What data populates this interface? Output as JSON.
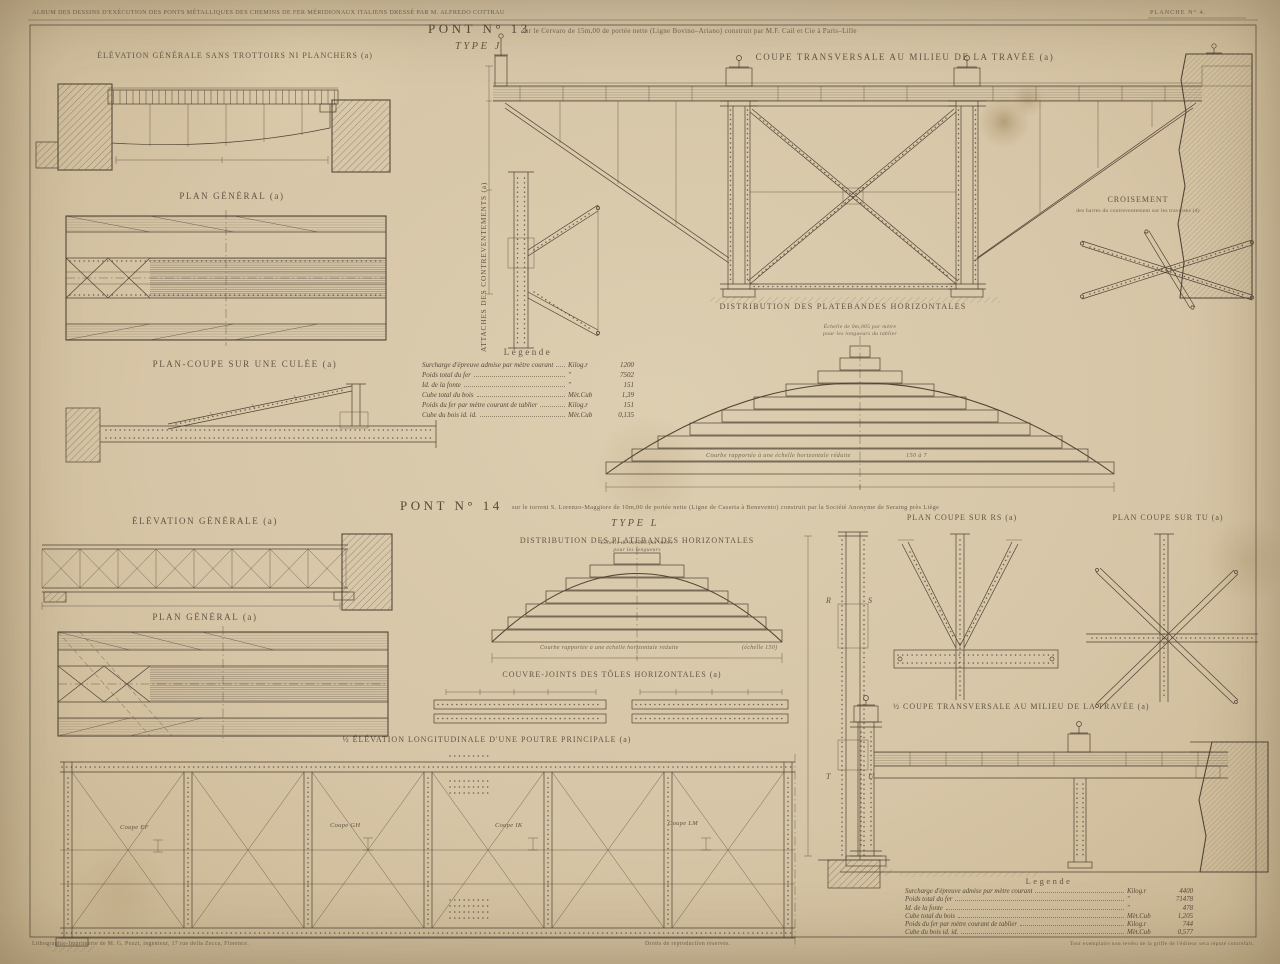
{
  "page": {
    "album_caption": "ALBUM DES DESSINS D'EXÉCUTION DES PONTS MÉTALLIQUES DES CHEMINS DE FER MÉRIDIONAUX ITALIENS DRESSÉ PAR M. ALFREDO COTTRAU",
    "plate_label": "PLANCHE N° 4.",
    "footer_left": "Lithographie-Imprimerie de M. G. Pozzi, ingénieur, 17 rue della Zecca, Florence.",
    "footer_center": "Droits de reproduction réservés.",
    "footer_right": "Tout exemplaire non revêtu de la griffe de l'éditeur sera réputé contrefait."
  },
  "pont13": {
    "title": "PONT N° 13",
    "subtitle": "sur le Cervaro de 15m,00 de portée nette (Ligne Bovino–Ariano) construit par M.F. Cail et Cie à Paris–Lille",
    "type_label": "TYPE J",
    "labels": {
      "elevation": "ÉLÉVATION GÉNÉRALE SANS TROTTOIRS NI PLANCHERS (a)",
      "plan": "PLAN GÉNÉRAL (a)",
      "plan_coupe": "PLAN-COUPE SUR UNE CULÉE (a)",
      "attaches": "ATTACHES DES CONTREVENTEMENTS (a)",
      "coupe": "COUPE TRANSVERSALE AU MILIEU DE LA TRAVÉE (a)",
      "croisement_title": "CROISEMENT",
      "croisement_sub": "des barres du contreventement sur les traverses (d)",
      "distribution": "DISTRIBUTION DES PLATEBANDES HORIZONTALES",
      "scale_note_1": "Échelle de 0m,005 par mètre",
      "scale_note_2": "pour les longueurs du tablier",
      "curve_note": "Courbe rapportée à une échelle horizontale réduite",
      "curve_ratio": "150 à 7"
    },
    "legend": {
      "title": "Légende",
      "rows": [
        {
          "label": "Surcharge d'épreuve admise par mètre courant",
          "unit": "Kilog.r",
          "value": "1200"
        },
        {
          "label": "Poids total du fer",
          "unit": "″",
          "value": "7502"
        },
        {
          "label": "Id.    de la fonte",
          "unit": "″",
          "value": "151"
        },
        {
          "label": "Cube total du bois",
          "unit": "Mèt.Cub",
          "value": "1,39"
        },
        {
          "label": "Poids du fer par mètre courant de tablier",
          "unit": "Kilog.r",
          "value": "151"
        },
        {
          "label": "Cube du bois   id.   id.",
          "unit": "Mèt.Cub",
          "value": "0,135"
        }
      ]
    }
  },
  "pont14": {
    "title": "PONT N° 14",
    "subtitle": "sur le torrent S. Lorenzo-Maggiore de 10m,00 de portée nette (Ligne de Caserta à Benevento) construit par la Société Anonyme de Seraing près Liège",
    "type_label": "TYPE L",
    "labels": {
      "elevation": "ÉLÉVATION GÉNÉRALE (a)",
      "plan": "PLAN GÉNÉRAL (a)",
      "distribution": "DISTRIBUTION DES PLATEBANDES HORIZONTALES",
      "couvre_joints": "COUVRE-JOINTS DES TÔLES HORIZONTALES (a)",
      "elevation_longitudinale": "½ ÉLÉVATION LONGITUDINALE D'UNE POUTRE PRINCIPALE (a)",
      "plan_rs": "PLAN COUPE SUR RS (a)",
      "plan_tu": "PLAN COUPE SUR TU (a)",
      "coupe": "½ COUPE TRANSVERSALE AU MILIEU DE LA TRAVÉE (a)",
      "scale_note_1": "Échelle de 0m,005 par mètre",
      "scale_note_2": "pour les longueurs",
      "curve_note": "Courbe rapportée à une échelle horizontale réduite",
      "curve_ratio": "(échelle 150)"
    },
    "coupes": [
      "Coupe EF",
      "Coupe GH",
      "Coupe IK",
      "Coupe LM"
    ],
    "section_letters": {
      "r": "R",
      "s": "S",
      "t": "T",
      "u": "U"
    },
    "legend": {
      "title": "Legende",
      "rows": [
        {
          "label": "Surcharge d'épreuve admise par mètre courant",
          "unit": "Kilog.r",
          "value": "4400"
        },
        {
          "label": "Poids total du fer",
          "unit": "″",
          "value": "71478"
        },
        {
          "label": "Id.    de la fonte",
          "unit": "″",
          "value": "478"
        },
        {
          "label": "Cube total du bois",
          "unit": "Mèt.Cub",
          "value": "1,205"
        },
        {
          "label": "Poids du fer par mètre courant de tablier",
          "unit": "Kilog.r",
          "value": "744"
        },
        {
          "label": "Cube du bois   id.   id.",
          "unit": "Mèt.Cub",
          "value": "0,577"
        }
      ]
    }
  }
}
